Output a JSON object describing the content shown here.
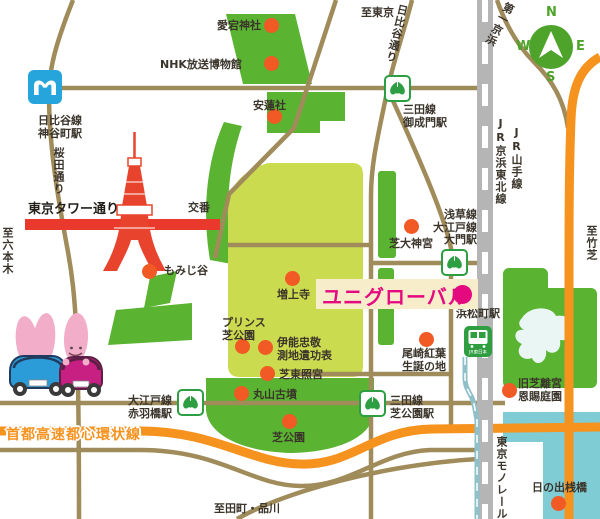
{
  "destination": {
    "name": "ユニグローバル"
  },
  "compass": {
    "north": "N",
    "south": "S",
    "east": "E",
    "west": "W"
  },
  "roads": {
    "tokyo_tower_street": "東京タワー通り",
    "sakurada_street": "桜田通り",
    "hibiya_street": "日比谷通り",
    "daiichi_keihin": "第一京浜",
    "shuto_expressway": "首都高速都心環状線"
  },
  "directions": {
    "to_roppongi": "至六本木",
    "to_tokyo": "至東京",
    "to_takeshiba": "至竹芝",
    "to_tamachi_shinagawa": "至田町・品川"
  },
  "railways": {
    "jr_keihin_tohoku": "JR京浜東北線",
    "jr_yamanote": "JR山手線",
    "tokyo_monorail": "東京モノレール"
  },
  "stations": {
    "kamiyacho": {
      "line": "日比谷線",
      "name": "神谷町駅"
    },
    "onarimon": {
      "line": "三田線",
      "name": "御成門駅"
    },
    "daimon": {
      "line1": "浅草線",
      "line2": "大江戸線",
      "name": "大門駅"
    },
    "akabanebashi": {
      "line": "大江戸線",
      "name": "赤羽橋駅"
    },
    "shibakoen": {
      "line": "三田線",
      "name": "芝公園駅"
    },
    "hamamatsucho": {
      "name": "浜松町駅",
      "operator": "JR東日本"
    }
  },
  "pois": {
    "atago_shrine": "愛宕神社",
    "nhk_museum": "NHK放送博物館",
    "anrensha": "安蓮社",
    "koban": "交番",
    "momijidani": "もみじ谷",
    "zojoji": "増上寺",
    "prince_shiba_park": {
      "line1": "プリンス",
      "line2": "芝公園"
    },
    "ino_tadataka": {
      "line1": "伊能忠敬",
      "line2": "測地遺功表"
    },
    "shiba_toshogu": "芝東照宮",
    "maruyama_kofun": "丸山古墳",
    "shiba_park": "芝公園",
    "shiba_daijingu": "芝大神宮",
    "ozaki_koyo": {
      "line1": "尾崎紅葉",
      "line2": "生誕の地"
    },
    "kyu_shiba_rikyu": {
      "line1": "旧芝離宮",
      "line2": "恩賜庭園"
    },
    "hinode_pier": "日の出桟橋"
  },
  "colors": {
    "route_red": "#e8392c",
    "highway_orange": "#f6921e",
    "park_green": "#5ab331",
    "park_lawn": "#cbdb4f",
    "road_tan": "#a08b5a",
    "rail_gray": "#b5b5b5",
    "water_teal": "#7fccd5",
    "metro_blue": "#26a5dc",
    "toei_green": "#2d9e41",
    "jr_green": "#2f9e41",
    "destination_magenta": "#e50980"
  }
}
